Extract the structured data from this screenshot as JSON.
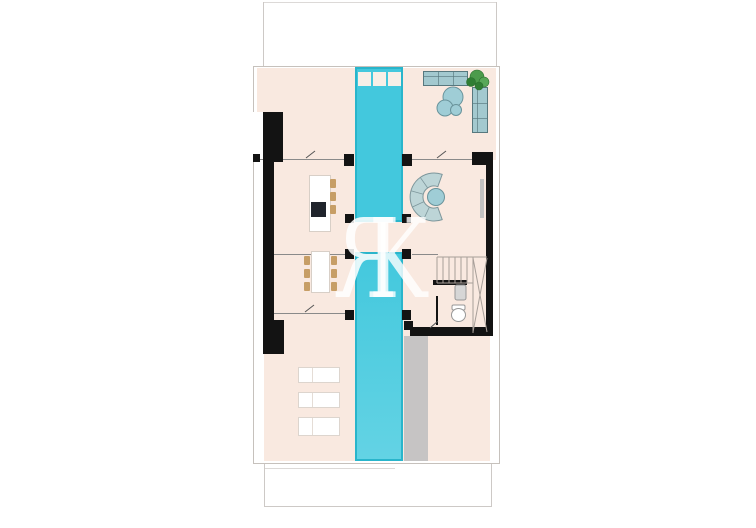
{
  "watermark": {
    "letter_r": "R",
    "letter_k": "K"
  },
  "colors": {
    "floor": "#f9e9e0",
    "pool_fill": "#43c8dd",
    "pool_border": "#29b5cb",
    "skylight": "#f7efe7",
    "wall": "#131313",
    "deck": "#c6c4c4",
    "boundary_line": "#cdc9c6",
    "plan_border": "#c6c1bc",
    "wall_line": "#8a8a8a",
    "sofa_fill": "#a3c9cf",
    "sofa_border": "#57787e",
    "table_fill": "#9fcdd6",
    "table_border": "#69939b",
    "curved_sofa_fill": "#bdd5d7",
    "curved_sofa_border": "#7d969b",
    "plant_dark": "#2f7d33",
    "plant_mid": "#4c9b4c",
    "plant_light": "#58a758",
    "wood": "#c79e66",
    "furniture_border": "#d8cfc7",
    "stair_line": "#a89f99",
    "fixture_fill": "#d6d6d6",
    "fixture_border": "#979797",
    "cooktop": "#20242c",
    "door_mark": "#555555"
  }
}
